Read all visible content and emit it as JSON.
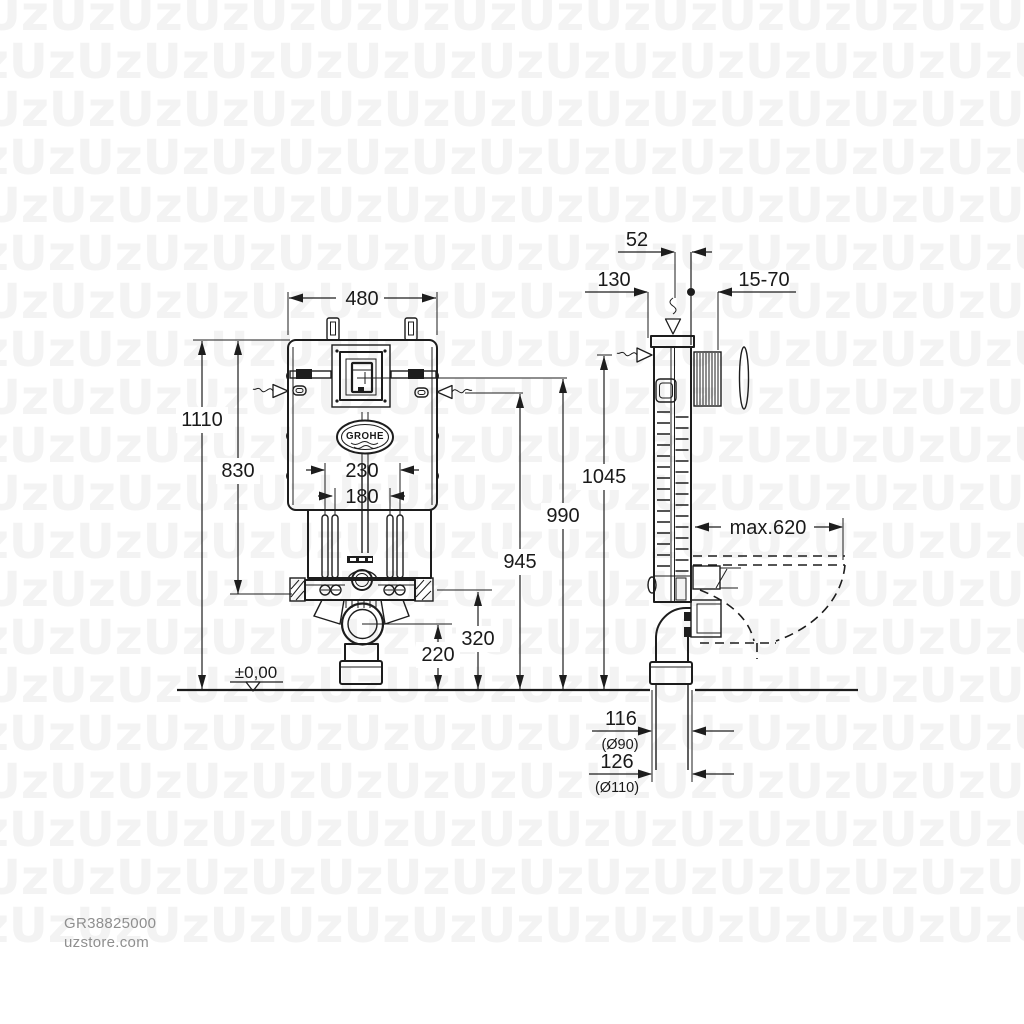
{
  "watermark": {
    "text": "Uz",
    "rows": 20,
    "cols": 18,
    "row_height": 48,
    "color": "#f3f3f3"
  },
  "footer": {
    "product_code": "GR38825000",
    "website": "uzstore.com"
  },
  "brand": {
    "logo_text": "GROHE"
  },
  "dims": {
    "front_width": "480",
    "total_height": "1110",
    "frame_height": "830",
    "rod_outer": "230",
    "rod_inner": "180",
    "bracket_height": "320",
    "outlet_height": "220",
    "floor_level": "±0,00",
    "h_flush_center": "990",
    "h_fixing": "945",
    "h_supply": "1045",
    "supply_offset": "52",
    "front_offset": "130",
    "finish_range": "15-70",
    "bowl_depth": "max.620",
    "drain90_offset": "116",
    "drain90_dia": "(Ø90)",
    "drain110_offset": "126",
    "drain110_dia": "(Ø110)"
  }
}
